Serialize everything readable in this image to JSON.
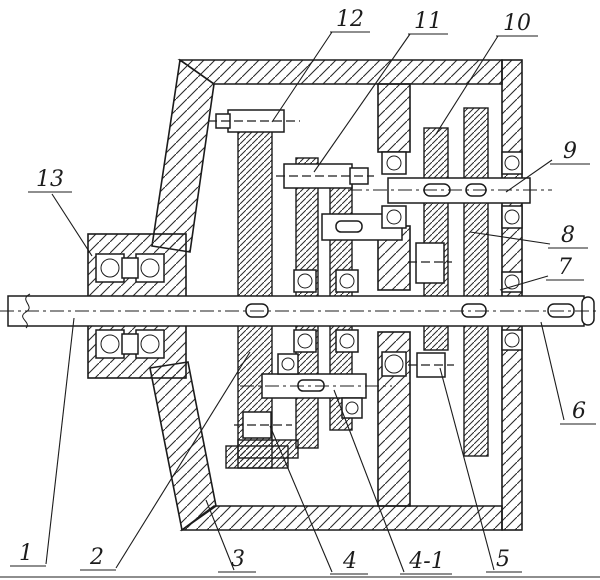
{
  "figure": {
    "kind": "mechanical-cross-section-drawing",
    "colors": {
      "ink": "#1c1c1c",
      "paper": "#ffffff"
    },
    "labels": [
      {
        "id": "1",
        "text": "1"
      },
      {
        "id": "2",
        "text": "2"
      },
      {
        "id": "3",
        "text": "3"
      },
      {
        "id": "4",
        "text": "4"
      },
      {
        "id": "4-1",
        "text": "4-1"
      },
      {
        "id": "5",
        "text": "5"
      },
      {
        "id": "6",
        "text": "6"
      },
      {
        "id": "7",
        "text": "7"
      },
      {
        "id": "8",
        "text": "8"
      },
      {
        "id": "9",
        "text": "9"
      },
      {
        "id": "10",
        "text": "10"
      },
      {
        "id": "11",
        "text": "11"
      },
      {
        "id": "12",
        "text": "12"
      },
      {
        "id": "13",
        "text": "13"
      }
    ]
  }
}
